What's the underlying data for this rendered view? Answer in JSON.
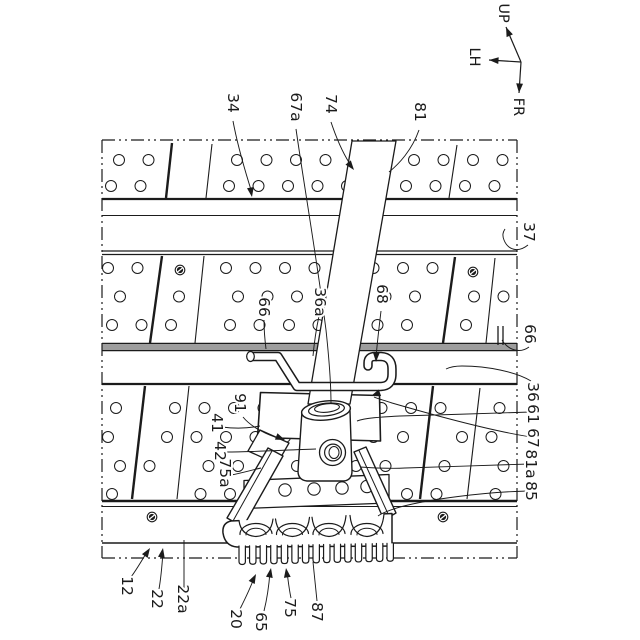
{
  "figure": {
    "kind": "patent-mechanism-drawing",
    "description": "Perspective view of perforated deck boards with rails, a diagonal pipe held by a hooked rod and a clamp unit with rollers and serrated base plate"
  },
  "colors": {
    "ink": "#1b1b1b",
    "rail_fill": "#9d9d9d",
    "paper": "#ffffff"
  },
  "axes": {
    "origin": [
      521,
      62
    ],
    "arrows": [
      {
        "label": "UP",
        "tip": [
          506,
          27
        ],
        "label_pos": [
          503,
          13
        ]
      },
      {
        "label": "LH",
        "tip": [
          489,
          60
        ],
        "label_pos": [
          474,
          57
        ]
      },
      {
        "label": "FR",
        "tip": [
          519,
          93
        ],
        "label_pos": [
          518,
          107
        ]
      }
    ]
  },
  "ref_labels": [
    {
      "text": "34",
      "x": 233,
      "y": 103,
      "leader": "M233,121 C238,148 246,174 252,193",
      "arrow": {
        "x": 252,
        "y": 197,
        "angle": 80
      }
    },
    {
      "text": "67a",
      "x": 296,
      "y": 107,
      "leader": "M296,129 C304,185 317,260 326,330 C329,358 331,385 331,404"
    },
    {
      "text": "74",
      "x": 331,
      "y": 104,
      "leader": "M331,122 C337,140 345,157 352,167",
      "arrow": {
        "x": 354,
        "y": 170,
        "angle": 52
      }
    },
    {
      "text": "81",
      "x": 420,
      "y": 112,
      "leader": "M419,130 C412,150 399,164 389,172"
    },
    {
      "text": "37",
      "x": 529,
      "y": 232,
      "leader": "M528,245 C518,253 508,250 504,240 C502,235 503,232 505,229"
    },
    {
      "text": "66",
      "x": 530,
      "y": 334,
      "leader": "M529,347 C521,353 511,351 504,343 L502,340"
    },
    {
      "text": "36",
      "x": 533,
      "y": 392,
      "leader": "M531,381 C516,372 488,366 462,366 C455,366 450,367 446,369"
    },
    {
      "text": "61",
      "x": 533,
      "y": 414,
      "leader": "M531,412 C500,413 440,415 400,416 C380,417 365,418 357,421"
    },
    {
      "text": "67",
      "x": 533,
      "y": 438,
      "leader": "M531,437 C492,431 430,414 392,403 C384,400 378,399 374,397",
      "arrow": {
        "x": 371,
        "y": 396,
        "angle": 160
      }
    },
    {
      "text": "81a",
      "x": 531,
      "y": 464,
      "leader": "M529,464 C495,465 440,467 405,468 C390,469 375,468 360,467"
    },
    {
      "text": "85",
      "x": 531,
      "y": 491,
      "leader": "M528,491 C485,492 430,499 400,507 C390,510 382,513 378,516"
    },
    {
      "text": "66",
      "x": 264,
      "y": 307,
      "leader": "M264,320 C264,330 265,341 266,349"
    },
    {
      "text": "36a",
      "x": 320,
      "y": 302,
      "leader": "M319,316 C316,330 314,345 313,356"
    },
    {
      "text": "68",
      "x": 382,
      "y": 294,
      "leader": "M381,311 C379,328 377,344 376,358",
      "arrow": {
        "x": 376,
        "y": 362,
        "angle": 92
      }
    },
    {
      "text": "91",
      "x": 240,
      "y": 403,
      "leader": "M243,417 C251,427 267,435 281,439",
      "arrow": {
        "x": 285,
        "y": 440,
        "angle": 22
      }
    },
    {
      "text": "41",
      "x": 217,
      "y": 423,
      "leader": "M222,427 C237,429 250,428 260,426"
    },
    {
      "text": "42",
      "x": 220,
      "y": 451,
      "leader": "M226,452 C253,452 285,450 316,449"
    },
    {
      "text": "75a",
      "x": 225,
      "y": 473,
      "leader": "M231,475 C242,473 252,470 261,468"
    },
    {
      "text": "12",
      "x": 127,
      "y": 586,
      "leader": "M131,577 C137,569 142,560 147,552",
      "arrow": {
        "x": 150,
        "y": 548,
        "angle": -57
      }
    },
    {
      "text": "22",
      "x": 157,
      "y": 599,
      "leader": "M159,589 C161,578 162,566 163,552",
      "arrow": {
        "x": 163,
        "y": 548,
        "angle": -80
      }
    },
    {
      "text": "22a",
      "x": 183,
      "y": 599,
      "leader": "M184,589 L184,540"
    },
    {
      "text": "20",
      "x": 236,
      "y": 619,
      "leader": "M240,609 C245,599 250,589 254,578",
      "arrow": {
        "x": 256,
        "y": 574,
        "angle": -63
      }
    },
    {
      "text": "65",
      "x": 261,
      "y": 622,
      "leader": "M264,611 C267,599 269,585 270,572",
      "arrow": {
        "x": 271,
        "y": 568,
        "angle": -80
      }
    },
    {
      "text": "75",
      "x": 290,
      "y": 608,
      "leader": "M291,598 C289,589 288,579 287,572",
      "arrow": {
        "x": 286,
        "y": 568,
        "angle": -98
      }
    },
    {
      "text": "87",
      "x": 317,
      "y": 612,
      "leader": "M317,601 L313,562"
    }
  ],
  "structure": {
    "border": {
      "x1": 102,
      "y1": 140,
      "x2": 517,
      "y2": 558,
      "dash": "13 4 2 4 2 4"
    },
    "hlines": [
      {
        "y": 199,
        "w": 2.2
      },
      {
        "y": 215.5,
        "w": 1.1
      },
      {
        "y": 251,
        "w": 1.3
      },
      {
        "y": 254.5,
        "w": 1.3
      },
      {
        "y": 343.5,
        "w": 1.4
      },
      {
        "y": 350.5,
        "w": 1.4
      },
      {
        "y": 384,
        "w": 2.2
      },
      {
        "y": 501,
        "w": 2.6
      },
      {
        "y": 506.5,
        "w": 1.1
      },
      {
        "y": 543,
        "w": 1.4
      }
    ],
    "rails": [
      {
        "x": 102,
        "y": 344.6,
        "w": 415,
        "h": 5.4
      }
    ],
    "rail_cap": [
      [
        498,
        326,
        498,
        345
      ],
      [
        503,
        326,
        503,
        345
      ]
    ],
    "hole": {
      "x0": 111,
      "x1": 513,
      "dx": 29.5,
      "r": 5.5
    },
    "panel_bands": [
      {
        "rows": [
          160,
          186
        ],
        "offsets": [
          8,
          0
        ]
      },
      {
        "rows": [
          268,
          296.5,
          325
        ],
        "offsets": [
          -3,
          9,
          1
        ]
      },
      {
        "rows": [
          408,
          437,
          466,
          494
        ],
        "offsets": [
          5,
          -3,
          9,
          1
        ]
      }
    ],
    "seams": [
      {
        "x1": 172,
        "y1": 143,
        "x2": 166,
        "y2": 198,
        "w": 2.4
      },
      {
        "x1": 212,
        "y1": 144,
        "x2": 206,
        "y2": 198,
        "w": 1.1
      },
      {
        "x1": 457,
        "y1": 145,
        "x2": 449,
        "y2": 198,
        "w": 1.1
      },
      {
        "x1": 162,
        "y1": 256,
        "x2": 150,
        "y2": 343,
        "w": 2.4
      },
      {
        "x1": 204,
        "y1": 256,
        "x2": 195,
        "y2": 343,
        "w": 1.1
      },
      {
        "x1": 455,
        "y1": 257,
        "x2": 443,
        "y2": 343,
        "w": 2.4
      },
      {
        "x1": 495,
        "y1": 258,
        "x2": 486,
        "y2": 343,
        "w": 1.1
      },
      {
        "x1": 145,
        "y1": 386,
        "x2": 132,
        "y2": 499,
        "w": 2.4
      },
      {
        "x1": 189,
        "y1": 386,
        "x2": 177,
        "y2": 499,
        "w": 1.1
      },
      {
        "x1": 433,
        "y1": 386,
        "x2": 420,
        "y2": 499,
        "w": 2.4
      },
      {
        "x1": 480,
        "y1": 388,
        "x2": 467,
        "y2": 499,
        "w": 1.1
      }
    ],
    "bolts": [
      [
        180,
        270
      ],
      [
        473,
        272
      ],
      [
        152,
        517
      ],
      [
        443,
        517
      ]
    ],
    "clamp": {
      "roller_centers": [
        256,
        292.5,
        329,
        367
      ],
      "window_halfw": 17,
      "top_edge": {
        "xL": 231,
        "yL": 521,
        "xR": 392,
        "yR": 513.5
      },
      "window_bottom": 536.5,
      "roller": {
        "rx": 16,
        "ry": 10.5,
        "cy": 534.5,
        "inner_rx": 10,
        "inner_ry": 6.5
      },
      "teeth": {
        "x0": 239,
        "x1": 387,
        "n": 15,
        "w": 6.4,
        "top": 546,
        "bot": 564.5,
        "slope_top": -0.018,
        "slope_bot": -0.022
      },
      "crossbar_holes": [
        [
          285,
          490
        ],
        [
          314,
          489
        ],
        [
          342,
          488
        ],
        [
          367,
          486.5
        ]
      ]
    }
  }
}
